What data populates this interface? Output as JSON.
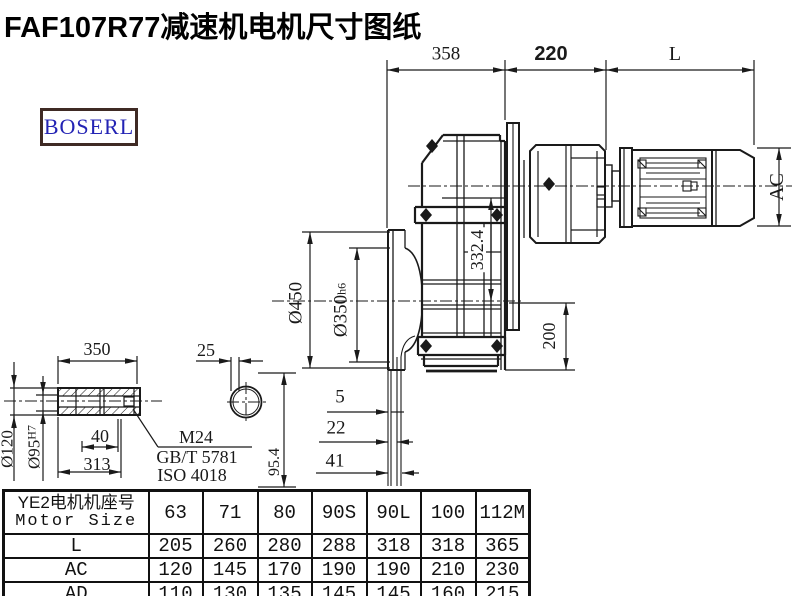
{
  "title": "FAF107R77减速机电机尺寸图纸",
  "logo": {
    "text": "BOSERL"
  },
  "dims": {
    "len358": "358",
    "len220": "220",
    "lenL": "L",
    "ac": "AC",
    "dia450": "Ø450",
    "dia350": {
      "main": "Ø350",
      "suffix": "h6"
    },
    "h332": "332.4",
    "h200": "200",
    "shaft350": "350",
    "key25": "25",
    "len40": "40",
    "len313": "313",
    "dia120": "Ø120",
    "dia95": {
      "main": "Ø95",
      "suffix": "H7"
    },
    "h954": "95.4",
    "off5": "5",
    "off22": "22",
    "off41": "41",
    "thread": "M24",
    "std_gb": "GB/T 5781",
    "std_iso": "ISO 4018"
  },
  "table": {
    "header_line1": "YE2电机机座号",
    "header_line2": "Motor Size",
    "sizes": [
      "63",
      "71",
      "80",
      "90S",
      "90L",
      "100",
      "112M"
    ],
    "rows": [
      {
        "label": "L",
        "values": [
          "205",
          "260",
          "280",
          "288",
          "318",
          "318",
          "365"
        ]
      },
      {
        "label": "AC",
        "values": [
          "120",
          "145",
          "170",
          "190",
          "190",
          "210",
          "230"
        ]
      },
      {
        "label": "AD",
        "values": [
          "110",
          "130",
          "135",
          "145",
          "145",
          "160",
          "215"
        ]
      }
    ]
  },
  "colors": {
    "line": "#1a1a1a",
    "logo_border": "#3f2a24",
    "logo_text": "#2323b4"
  }
}
